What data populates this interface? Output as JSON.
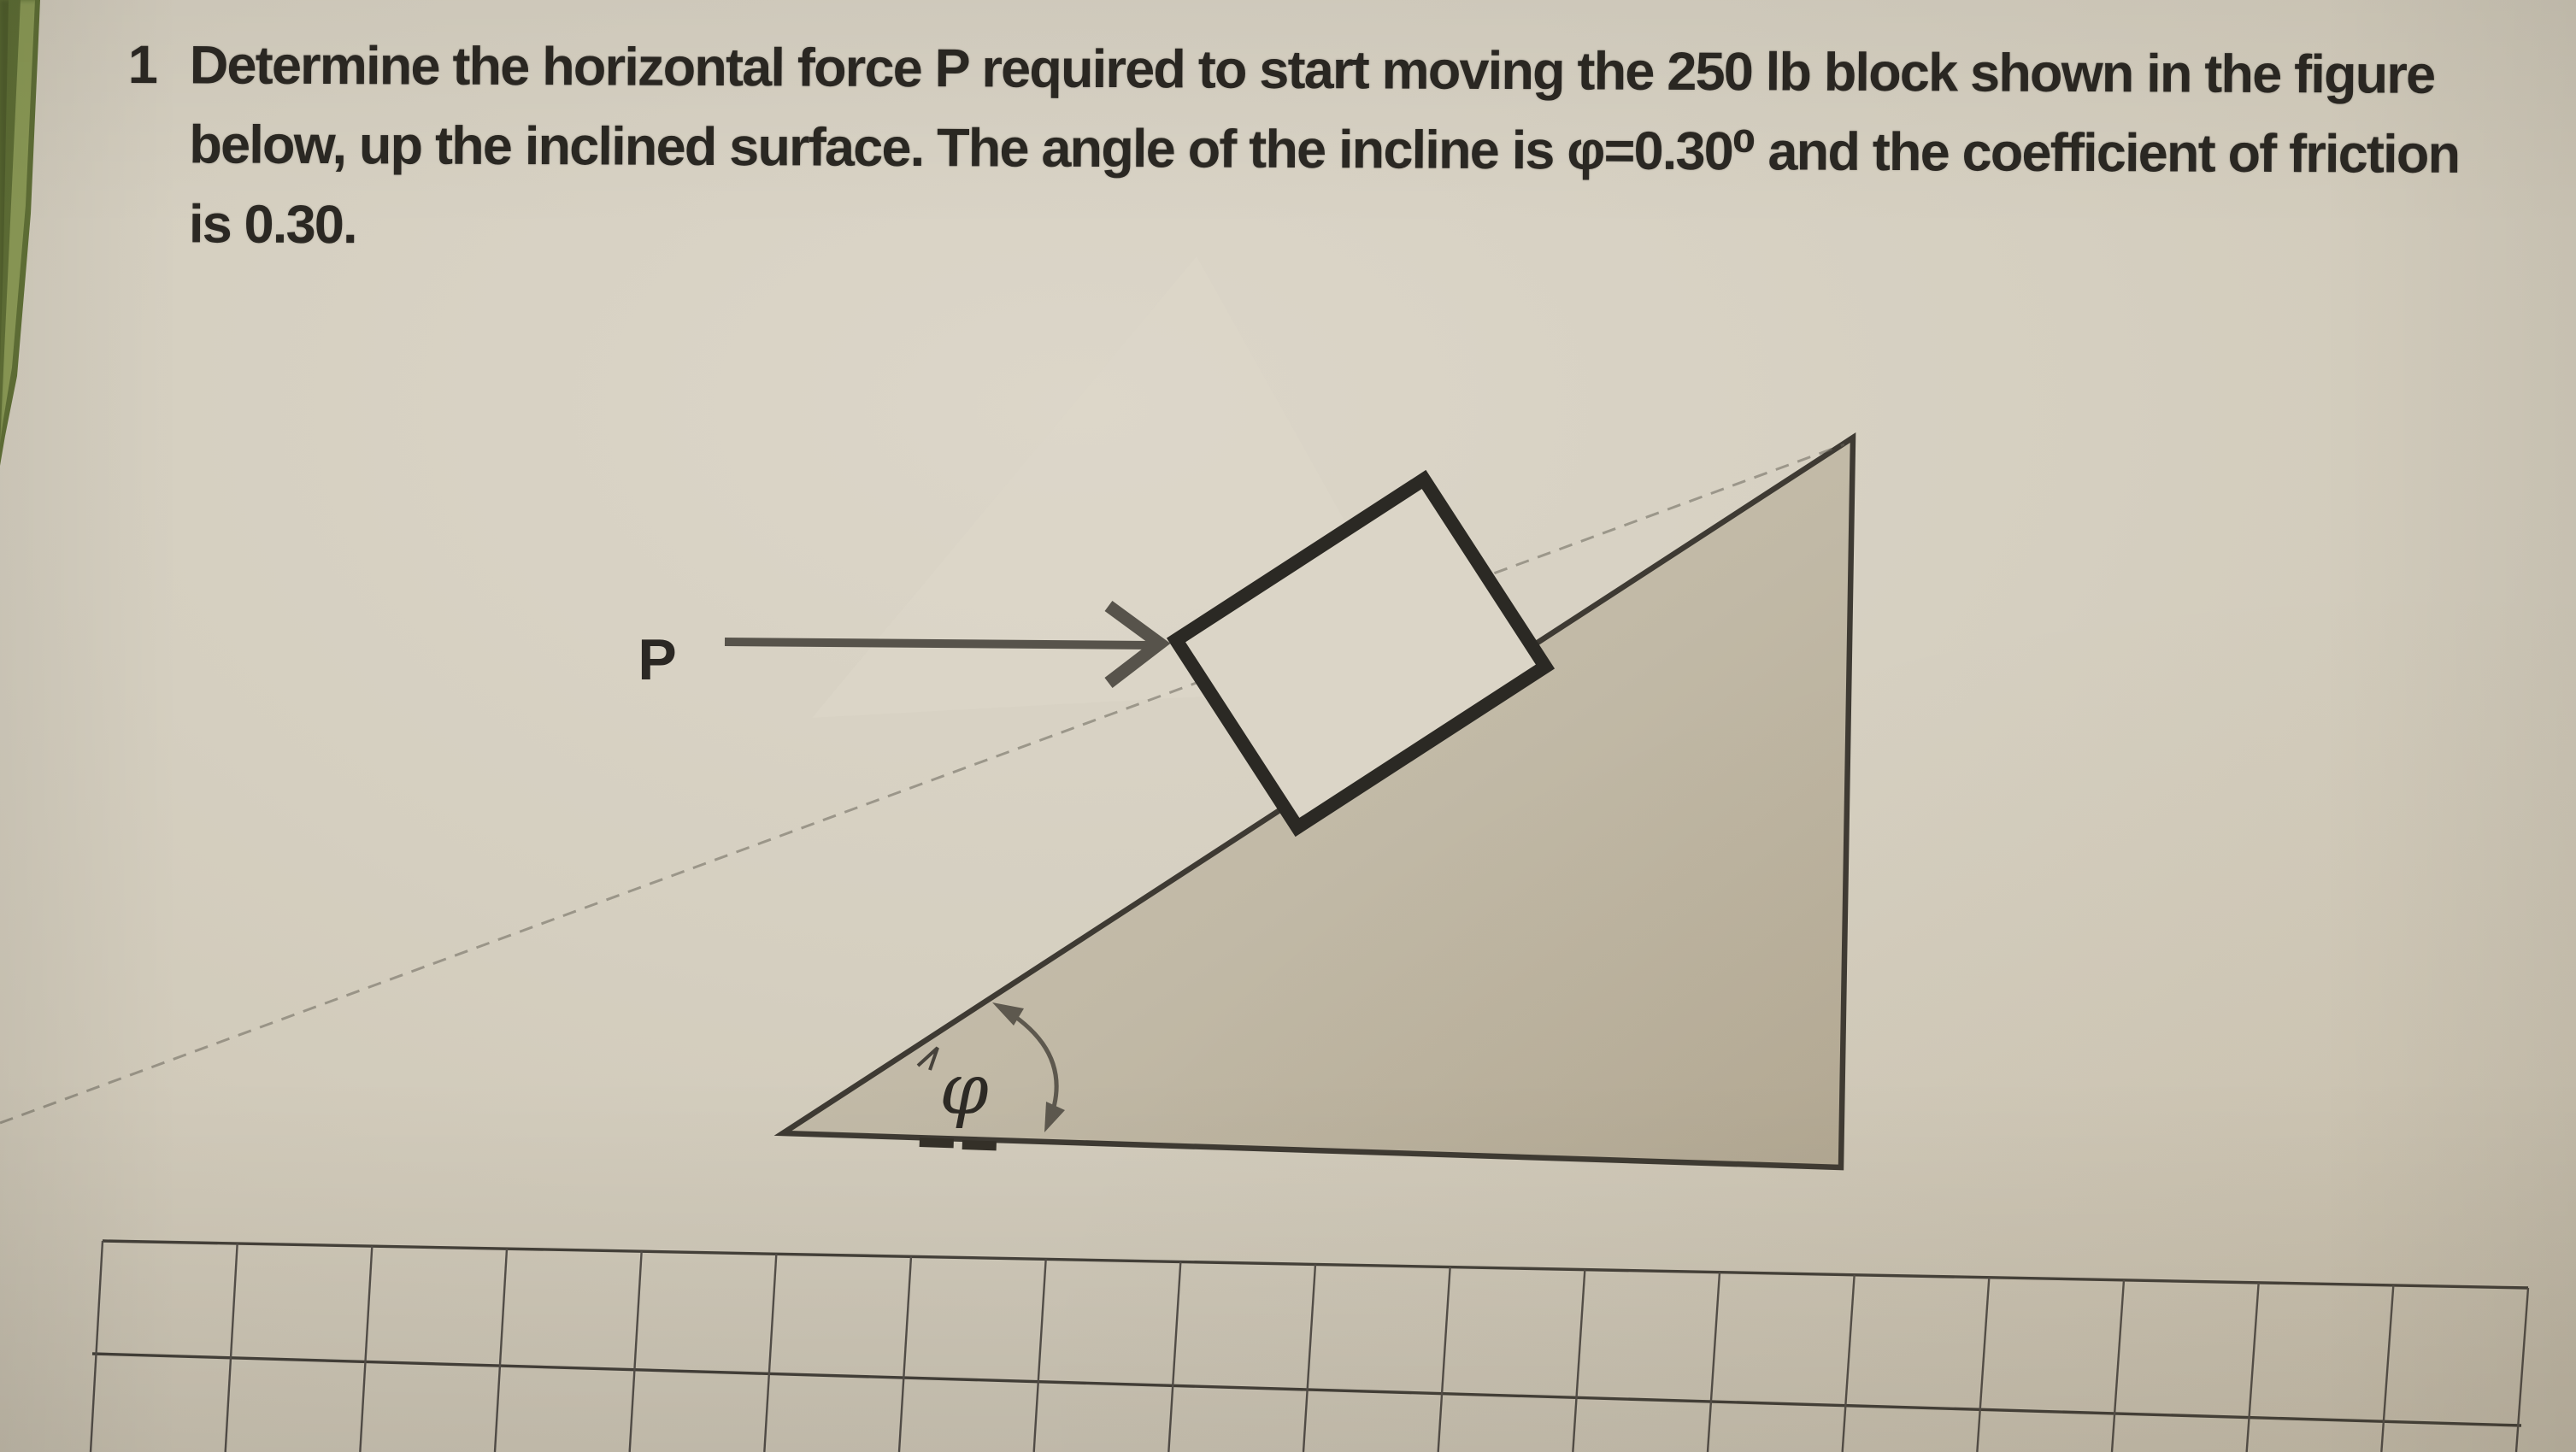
{
  "problem": {
    "number": "1",
    "lines": [
      "Determine the horizontal force P required to start moving the 250 lb block shown in the figure",
      "below, up the inclined surface. The angle of the incline is φ=0.30⁰ and the coefficient of friction",
      "is 0.30."
    ]
  },
  "figure": {
    "force_label": "P",
    "angle_label": "φ"
  },
  "grid": {
    "column_lines": 19,
    "visible_row_lines": 2
  },
  "colors": {
    "paper": "#d5cfc0",
    "book_edge_green": "#75853f",
    "ink": "#2b2823",
    "triangle_fill": "#c2bba8",
    "figure_line_dark": "#3e3a33",
    "arrow_gray": "#57534b",
    "grid_line_vertical": "#55504a",
    "grid_line_horizontal": "#45413a"
  }
}
